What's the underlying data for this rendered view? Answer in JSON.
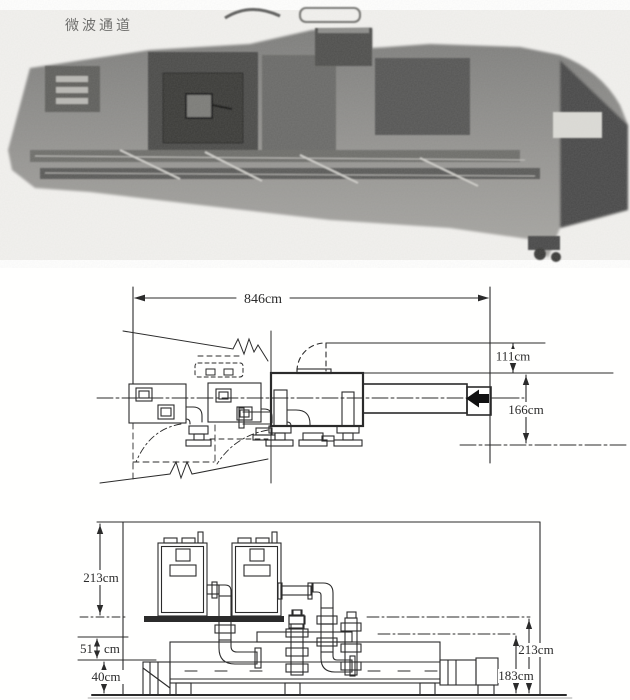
{
  "figure": {
    "photo_label": "微波通道",
    "plan": {
      "length": "846cm",
      "upper_width": "111cm",
      "total_width": "166cm"
    },
    "side": {
      "cabinet_height": "213cm",
      "gap_value": "51",
      "gap_unit": "cm",
      "base_height": "40cm",
      "total_height": "213cm",
      "body_height": "183cm"
    },
    "colors": {
      "ink": "#2b2b2b",
      "paper": "#ffffff",
      "photo_gray": "#8f8f8f"
    }
  }
}
